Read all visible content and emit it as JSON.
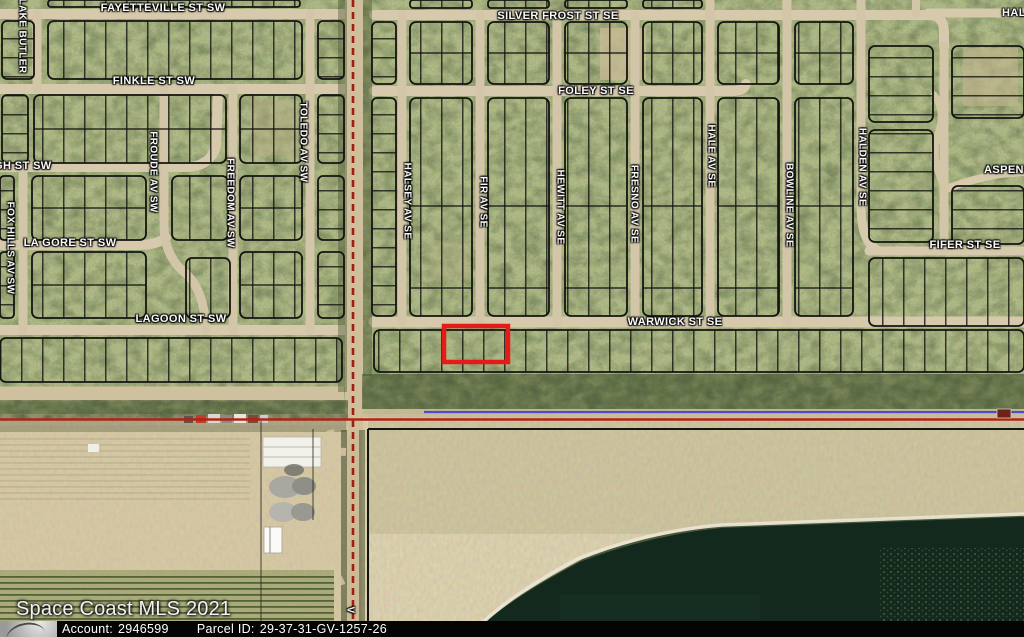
{
  "map": {
    "attribution": "Space Coast MLS 2021",
    "streets_horizontal": [
      {
        "name": "fayetteville-st-sw",
        "label": "FAYETTEVILLE ST SW"
      },
      {
        "name": "silver-frost-st-se",
        "label": "SILVER FROST ST SE"
      },
      {
        "name": "finkle-st-sw",
        "label": "FINKLE ST SW"
      },
      {
        "name": "foley-st-se",
        "label": "FOLEY ST SE"
      },
      {
        "name": "gh-st-sw-partial",
        "label": "GH ST SW"
      },
      {
        "name": "la-gore-st-sw",
        "label": "LA GORE ST SW"
      },
      {
        "name": "lagoon-st-sw",
        "label": "LAGOON ST SW"
      },
      {
        "name": "warwick-st-se",
        "label": "WARWICK ST SE"
      },
      {
        "name": "fifer-st-se",
        "label": "FIFER ST SE"
      },
      {
        "name": "aspen-r-partial",
        "label": "ASPEN R"
      },
      {
        "name": "hal-partial",
        "label": "HAL"
      }
    ],
    "streets_vertical": [
      {
        "name": "lake-butler",
        "label": "LAKE BUTLER"
      },
      {
        "name": "froude-av-sw",
        "label": "FROUDE AV SW"
      },
      {
        "name": "freedom-av-sw",
        "label": "FREEDOM AV SW"
      },
      {
        "name": "toledo-av-sw",
        "label": "TOLEDO AV SW"
      },
      {
        "name": "fox-hills-av-sw",
        "label": "FOX HILLS AV SW"
      },
      {
        "name": "halsey-av-se",
        "label": "HALSEY AV SE"
      },
      {
        "name": "fir-av-se",
        "label": "FIR AV SE"
      },
      {
        "name": "hewitt-av-se",
        "label": "HEWITT AV SE"
      },
      {
        "name": "fresno-av-se",
        "label": "FRESNO AV SE"
      },
      {
        "name": "hale-av-se",
        "label": "HALE AV SE"
      },
      {
        "name": "bowline-av-se",
        "label": "BOWLINE AV SE"
      },
      {
        "name": "halden-av-se",
        "label": "HALDEN AV SE"
      },
      {
        "name": "v-partial",
        "label": "V"
      }
    ],
    "colors": {
      "parcel_highlight": "#e41b17",
      "boundary_red_line": "#b02318",
      "boundary_blue_line": "#4040cf",
      "boundary_black_line": "#141410",
      "road_tan": "#d6c9ac",
      "water_dark": "#13291e"
    }
  },
  "watermark": "Space Coast MLS 2021",
  "footer": {
    "account_label": "Account:",
    "account_value": "2946599",
    "parcel_id_label": "Parcel ID:",
    "parcel_id_value": "29-37-31-GV-1257-26"
  }
}
